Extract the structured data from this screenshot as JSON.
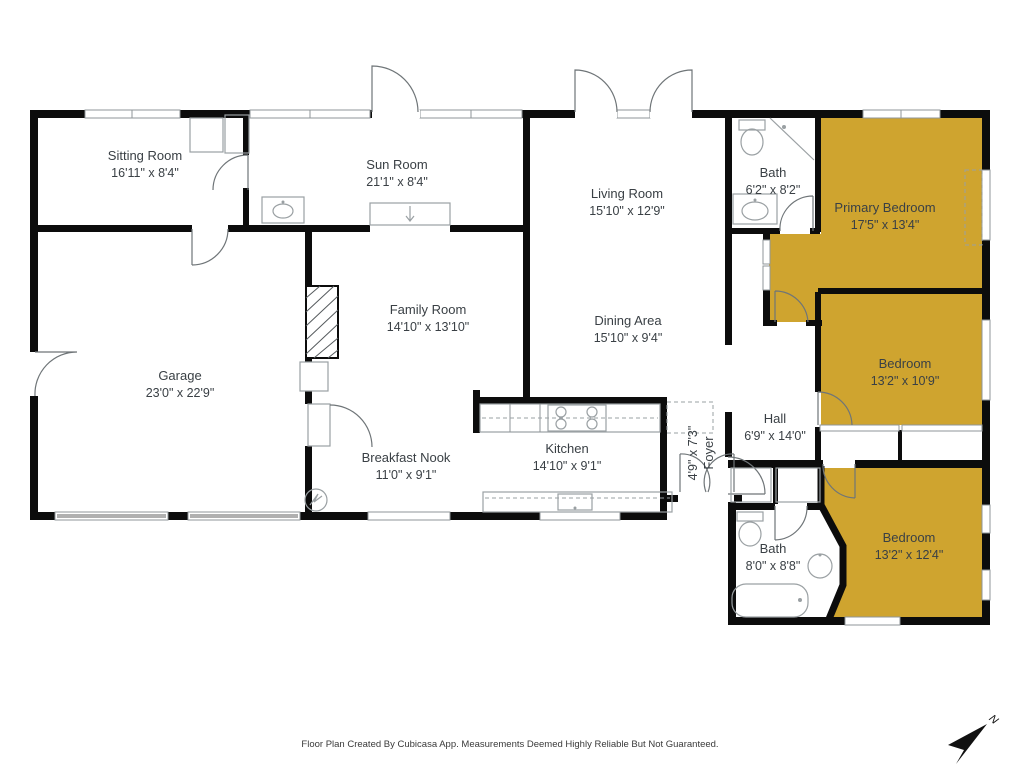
{
  "colors": {
    "highlight": "#CFA42F",
    "wall": "#0C0C0C",
    "label": "#3A4045"
  },
  "rooms": [
    {
      "id": "sitting-room",
      "name": "Sitting Room",
      "dims": "16'11\" x 8'4\"",
      "highlighted": false
    },
    {
      "id": "sun-room",
      "name": "Sun Room",
      "dims": "21'1\" x 8'4\"",
      "highlighted": false
    },
    {
      "id": "living-room",
      "name": "Living Room",
      "dims": "15'10\" x 12'9\"",
      "highlighted": false
    },
    {
      "id": "bath-upper",
      "name": "Bath",
      "dims": "6'2\" x 8'2\"",
      "highlighted": false
    },
    {
      "id": "primary-bedroom",
      "name": "Primary Bedroom",
      "dims": "17'5\" x 13'4\"",
      "highlighted": true
    },
    {
      "id": "family-room",
      "name": "Family Room",
      "dims": "14'10\" x 13'10\"",
      "highlighted": false
    },
    {
      "id": "dining-area",
      "name": "Dining Area",
      "dims": "15'10\" x 9'4\"",
      "highlighted": false
    },
    {
      "id": "garage",
      "name": "Garage",
      "dims": "23'0\" x 22'9\"",
      "highlighted": false
    },
    {
      "id": "bedroom-middle",
      "name": "Bedroom",
      "dims": "13'2\" x 10'9\"",
      "highlighted": true
    },
    {
      "id": "hall",
      "name": "Hall",
      "dims": "6'9\" x 14'0\"",
      "highlighted": false
    },
    {
      "id": "foyer",
      "name": "Foyer",
      "dims": "4'9\" x 7'3\"",
      "highlighted": false
    },
    {
      "id": "breakfast-nook",
      "name": "Breakfast Nook",
      "dims": "11'0\" x 9'1\"",
      "highlighted": false
    },
    {
      "id": "kitchen",
      "name": "Kitchen",
      "dims": "14'10\" x 9'1\"",
      "highlighted": false
    },
    {
      "id": "bath-lower",
      "name": "Bath",
      "dims": "8'0\" x 8'8\"",
      "highlighted": false
    },
    {
      "id": "bedroom-lower",
      "name": "Bedroom",
      "dims": "13'2\" x 12'4\"",
      "highlighted": true
    }
  ],
  "footer": "Floor Plan Created By Cubicasa App. Measurements Deemed Highly Reliable But Not Guaranteed.",
  "compass": {
    "label": "N"
  }
}
